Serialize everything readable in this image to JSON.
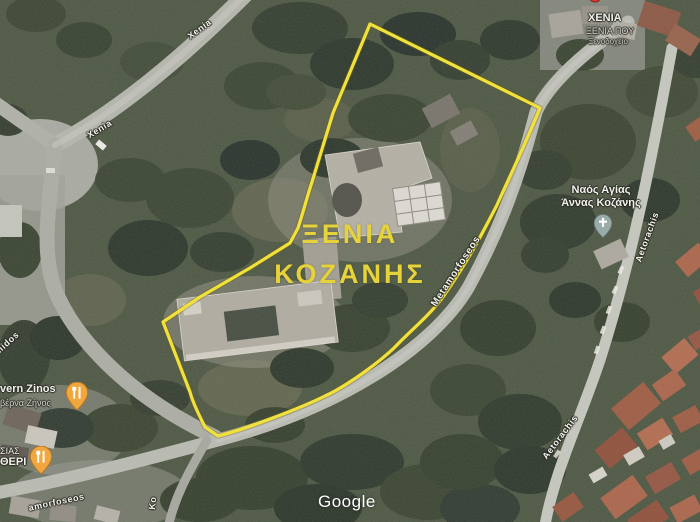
{
  "map": {
    "annotation": {
      "parcel_name_line1": "ΞΕΝΙΑ",
      "parcel_name_line2": "ΚΟΖΑΝΗΣ",
      "outline_color": "#f2e13b",
      "label_color": "#e6d23b"
    },
    "streets": [
      {
        "name": "Xenia"
      },
      {
        "name": "Xenia"
      },
      {
        "name": "Metamorfoseos"
      },
      {
        "name": "Aetorachis"
      },
      {
        "name": "Aetorachis"
      },
      {
        "name": "midos"
      },
      {
        "name": "amorfoseos"
      },
      {
        "name": "Ko"
      }
    ],
    "pois": [
      {
        "id": "hotel-xenia",
        "line1": "ΧΕΝΙΑ",
        "line2": "ΞΕΝΙΑ ΠΟΥ",
        "line3": "Ξενοδοχείο"
      },
      {
        "id": "church-agia-anna",
        "line1": "Ναός Αγίας",
        "line2": "Άννας Κοζάνης",
        "icon": "church-pin"
      },
      {
        "id": "tavern-zinos",
        "line1": "vern Zinos",
        "line2": "βέρνα Ζήνος",
        "icon": "restaurant-pin"
      },
      {
        "id": "tavern-bottom",
        "line1": "ΣΙΑΣ",
        "line2": "ΘΕΡΙ",
        "icon": "restaurant-pin"
      }
    ],
    "watermark": "Google",
    "colors": {
      "tree_dark": "#2b352a",
      "tree_mid": "#3a4432",
      "road_grey": "#b3b4ac",
      "roof_red": "#9c5a41",
      "pin_orange": "#f0a73e",
      "pin_church": "#9aaca8"
    }
  }
}
